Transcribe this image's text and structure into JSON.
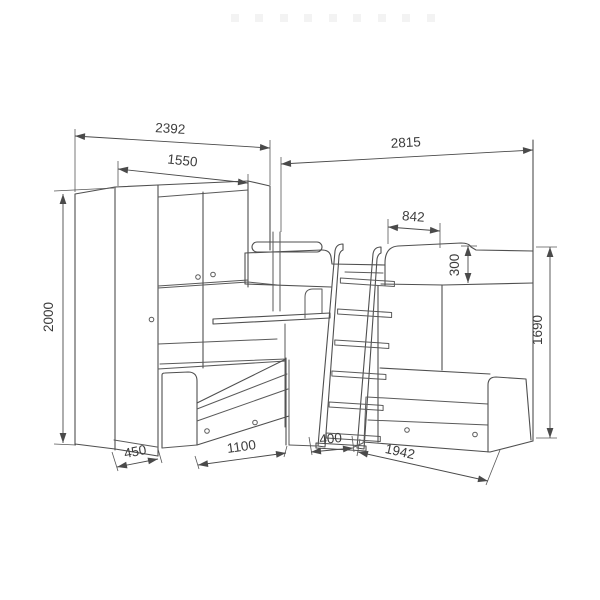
{
  "diagram": {
    "components": {
      "wardrobe": "wardrobe",
      "overhead_cabinet": "overhead-cabinet",
      "upper_bunk": "upper-bunk-bed",
      "safety_rail": "safety-rail",
      "ladder": "ladder",
      "desk_shelf": "desk-shelf",
      "left_bed": "left-bed-with-drawers",
      "right_bed": "right-bed-with-drawers"
    },
    "dimensions": {
      "left_wall_total": "2392",
      "upper_cabinet_section": "1550",
      "right_wall_total": "2815",
      "upper_bed_head_section": "842",
      "upper_bed_rail_height": "300",
      "wardrobe_height": "2000",
      "upper_bed_height": "1690",
      "wardrobe_depth": "450",
      "left_bed_front_length": "1100",
      "ladder_base_width": "400",
      "right_bed_length": "1942"
    }
  }
}
